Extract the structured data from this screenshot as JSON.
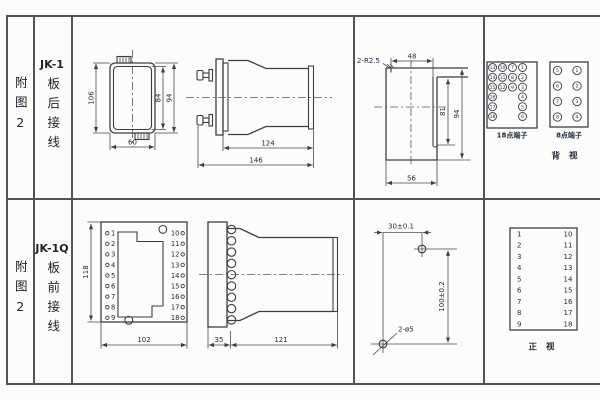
{
  "row_top": {
    "figure_label": "附图2",
    "model": "JK-1",
    "wiring": "板后接线",
    "front_view": {
      "dim_height": "106",
      "dim_inner": "84",
      "dim_outer": "94",
      "dim_width": "60"
    },
    "side_view": {
      "dim_body": "124",
      "dim_total": "146"
    },
    "cutout": {
      "dim_radius": "2-R2.5",
      "dim_top": "48",
      "dim_inner_h": "81",
      "dim_h": "94",
      "dim_w": "56"
    },
    "terminals": {
      "t18_label": "18点端子",
      "t8_label": "8点端子",
      "view_label": "背 视",
      "t18_rows": [
        [
          "13",
          "10",
          "7",
          "1"
        ],
        [
          "14",
          "11",
          "8",
          "2"
        ],
        [
          "15",
          "12",
          "9",
          "3"
        ],
        [
          "16",
          "",
          "",
          "4"
        ],
        [
          "17",
          "",
          "",
          "5"
        ],
        [
          "18",
          "",
          "",
          "6"
        ]
      ],
      "t8_rows": [
        [
          "5",
          "1"
        ],
        [
          "6",
          "2"
        ],
        [
          "7",
          "3"
        ],
        [
          "8",
          "4"
        ]
      ]
    }
  },
  "row_bottom": {
    "figure_label": "附图2",
    "model": "JK-1Q",
    "wiring": "板前接线",
    "socket_view": {
      "dim_height": "118",
      "dim_width": "102",
      "left_terminals": [
        "1",
        "2",
        "3",
        "4",
        "5",
        "6",
        "7",
        "8",
        "9"
      ],
      "right_terminals": [
        "10",
        "11",
        "12",
        "13",
        "14",
        "15",
        "16",
        "17",
        "18"
      ]
    },
    "side_view": {
      "dim_plate": "35",
      "dim_body": "121"
    },
    "drill": {
      "dim_x": "30±0.1",
      "dim_y": "100±0.2",
      "dim_hole": "2-ø5"
    },
    "front_table": {
      "left": [
        "1",
        "2",
        "3",
        "4",
        "5",
        "6",
        "7",
        "8",
        "9"
      ],
      "right": [
        "10",
        "11",
        "12",
        "13",
        "14",
        "15",
        "16",
        "17",
        "18"
      ],
      "view_label": "正 视"
    }
  }
}
